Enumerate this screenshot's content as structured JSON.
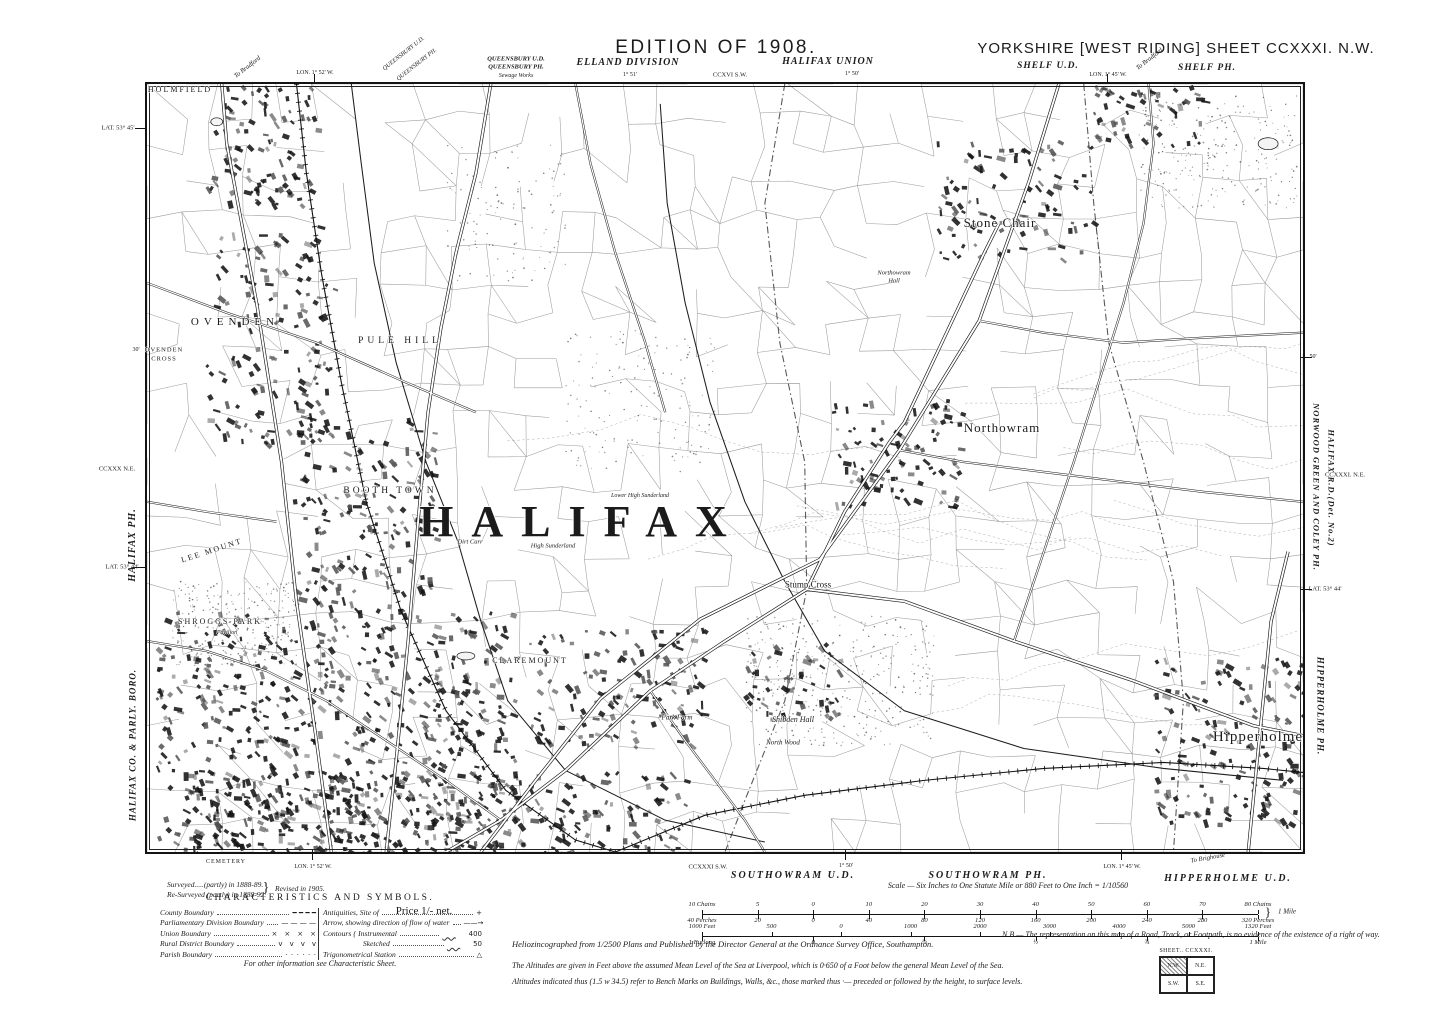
{
  "sheet_meta": {
    "edition": "EDITION OF 1908.",
    "series_title": "YORKSHIRE [WEST RIDING] SHEET CCXXXI. N.W.",
    "main_town": "HALIFAX"
  },
  "annotations": {
    "top": [
      {
        "n": "edition-label",
        "t": "EDITION OF 1908.",
        "x": 716,
        "y": 48,
        "s": 19,
        "f": "sans",
        "ls": 2.5
      },
      {
        "n": "sheet-title",
        "t": "YORKSHIRE [WEST RIDING] SHEET CCXXXI. N.W.",
        "x": 1176,
        "y": 49,
        "s": 15,
        "f": "sans",
        "ls": 1
      },
      {
        "n": "queensbury-ud-label",
        "t": "QUEENSBURY U.D.",
        "x": 516,
        "y": 60,
        "s": 6.5,
        "i": 1,
        "b": 1
      },
      {
        "n": "queensbury-ph-label",
        "t": "QUEENSBURY PH.",
        "x": 516,
        "y": 68,
        "s": 6.5,
        "i": 1,
        "b": 1
      },
      {
        "n": "sewage-works-label",
        "t": "Sewage Works",
        "x": 516,
        "y": 76,
        "s": 6,
        "i": 1
      },
      {
        "n": "elland-division-label",
        "t": "ELLAND DIVISION",
        "x": 628,
        "y": 63,
        "s": 10,
        "i": 1,
        "b": 1,
        "ls": 1
      },
      {
        "n": "lon-1-51-top",
        "t": "1° 51'",
        "x": 630,
        "y": 75,
        "s": 6
      },
      {
        "n": "adjacent-sheet-ccxvi-sw",
        "t": "CCXVI S.W.",
        "x": 730,
        "y": 76,
        "s": 6.5
      },
      {
        "n": "halifax-union-label",
        "t": "HALIFAX UNION",
        "x": 828,
        "y": 62,
        "s": 10,
        "i": 1,
        "b": 1,
        "ls": 1
      },
      {
        "n": "lon-1-50-top",
        "t": "1° 50'",
        "x": 852,
        "y": 74,
        "s": 6
      },
      {
        "n": "shelf-ud-label",
        "t": "SHELF U.D.",
        "x": 1048,
        "y": 67,
        "s": 9.5,
        "i": 1,
        "b": 1,
        "ls": 1
      },
      {
        "n": "lon-1-45-top",
        "t": "LON. 1° 45' W.",
        "x": 1108,
        "y": 75,
        "s": 6
      },
      {
        "n": "shelf-ph-label",
        "t": "SHELF PH.",
        "x": 1207,
        "y": 69,
        "s": 9.5,
        "i": 1,
        "b": 1,
        "ls": 1
      },
      {
        "n": "to-bradford-right",
        "t": "To Bradford",
        "x": 1150,
        "y": 60,
        "s": 6.5,
        "i": 1,
        "rot": -38
      },
      {
        "n": "lon-1-52-top",
        "t": "LON. 1° 52' W.",
        "x": 315,
        "y": 73,
        "s": 6
      },
      {
        "n": "to-bradford-left",
        "t": "To Bradford",
        "x": 248,
        "y": 68,
        "s": 6.5,
        "i": 1,
        "rot": -38
      },
      {
        "n": "queensbury-ud-diagonal",
        "t": "QUEENSBURY U.D.",
        "x": 404,
        "y": 54,
        "s": 6,
        "i": 1,
        "rot": -38
      },
      {
        "n": "queensbury-ph-diagonal",
        "t": "QUEENSBURY PH.",
        "x": 417,
        "y": 65,
        "s": 6,
        "i": 1,
        "rot": -38
      }
    ],
    "left": [
      {
        "n": "lat-53-45-left",
        "t": "LAT. 53° 45'",
        "x": 118,
        "y": 129,
        "s": 6.5
      },
      {
        "n": "min-30-left",
        "t": "30'",
        "x": 136,
        "y": 350,
        "s": 6
      },
      {
        "n": "adjacent-sheet-ccxxx-ne",
        "t": "CCXXX N.E.",
        "x": 117,
        "y": 470,
        "s": 6.5
      },
      {
        "n": "halifax-ph-margin",
        "t": "HALIFAX PH.",
        "x": 133,
        "y": 545,
        "s": 10,
        "i": 1,
        "b": 1,
        "rot": -90,
        "ls": 1
      },
      {
        "n": "lat-53-44-left",
        "t": "LAT. 53° 44'",
        "x": 122,
        "y": 568,
        "s": 6.5
      },
      {
        "n": "halifax-boro-margin",
        "t": "HALIFAX CO. & PARLY. BORO.",
        "x": 133,
        "y": 745,
        "s": 9,
        "i": 1,
        "b": 1,
        "rot": -90,
        "ls": 1
      }
    ],
    "right": [
      {
        "n": "min-50-right",
        "t": "50'",
        "x": 1313,
        "y": 357,
        "s": 6
      },
      {
        "n": "norwood-green-coley-ph-margin",
        "t": "NORWOOD GREEN AND COLEY PH.",
        "x": 1316,
        "y": 487,
        "s": 8.5,
        "i": 1,
        "b": 1,
        "rot": 90,
        "ls": 1
      },
      {
        "n": "halifax-rd-margin",
        "t": "HALIFAX R.D.(Det. No.2)",
        "x": 1331,
        "y": 488,
        "s": 8.5,
        "i": 1,
        "b": 1,
        "rot": 90,
        "ls": 1
      },
      {
        "n": "adjacent-sheet-ccxxxi-ne",
        "t": "CCXXXI. N.E.",
        "x": 1345,
        "y": 476,
        "s": 6.5
      },
      {
        "n": "lat-53-44-right",
        "t": "LAT. 53° 44'",
        "x": 1325,
        "y": 590,
        "s": 6.5
      },
      {
        "n": "hipperholme-ph-margin",
        "t": "HIPPERHOLME PH.",
        "x": 1320,
        "y": 706,
        "s": 9,
        "i": 1,
        "b": 1,
        "rot": 90,
        "ls": 1
      }
    ],
    "bottom": [
      {
        "n": "cemetery-label",
        "t": "CEMETERY",
        "x": 226,
        "y": 862,
        "s": 6,
        "ls": 1
      },
      {
        "n": "lon-1-52-bottom",
        "t": "LON. 1° 52' W.",
        "x": 313,
        "y": 867,
        "s": 6
      },
      {
        "n": "adjacent-sheet-ccxxxi-sw",
        "t": "CCXXXI S.W.",
        "x": 708,
        "y": 868,
        "s": 6.5
      },
      {
        "n": "lon-1-50-bottom",
        "t": "1° 50'",
        "x": 846,
        "y": 866,
        "s": 6
      },
      {
        "n": "southowram-ud-label",
        "t": "SOUTHOWRAM U.D.",
        "x": 793,
        "y": 876,
        "s": 10,
        "i": 1,
        "b": 1,
        "ls": 2
      },
      {
        "n": "southowram-ph-label",
        "t": "SOUTHOWRAM PH.",
        "x": 988,
        "y": 876,
        "s": 10,
        "i": 1,
        "b": 1,
        "ls": 2
      },
      {
        "n": "lon-1-45-bottom",
        "t": "LON. 1° 45' W.",
        "x": 1122,
        "y": 867,
        "s": 6
      },
      {
        "n": "to-brighouse-label",
        "t": "To Brighouse",
        "x": 1208,
        "y": 859,
        "s": 6.5,
        "i": 1,
        "rot": -10
      },
      {
        "n": "hipperholme-ud-label",
        "t": "HIPPERHOLME U.D.",
        "x": 1228,
        "y": 879,
        "s": 10,
        "i": 1,
        "b": 1,
        "ls": 2
      },
      {
        "n": "survey-line-1",
        "t": "Surveyed.....(partly) in 1888-89.",
        "x": 167,
        "y": 881,
        "s": 7.5,
        "i": 1,
        "a": "tl"
      },
      {
        "n": "survey-line-2",
        "t": "Re-Surveyed (partly) in 1888-92.",
        "x": 167,
        "y": 891,
        "s": 7.5,
        "i": 1,
        "a": "tl"
      },
      {
        "n": "survey-brace",
        "t": "}",
        "x": 266,
        "y": 889,
        "s": 14
      },
      {
        "n": "survey-line-3",
        "t": "Revised in 1905.",
        "x": 275,
        "y": 885,
        "s": 7.5,
        "i": 1,
        "a": "tl"
      },
      {
        "n": "characteristics-title",
        "t": "CHARACTERISTICS AND SYMBOLS.",
        "x": 320,
        "y": 899,
        "s": 9.5,
        "ls": 2.5
      },
      {
        "n": "legend-footnote",
        "t": "For other information see Characteristic Sheet.",
        "x": 320,
        "y": 964,
        "s": 8,
        "i": 1
      },
      {
        "n": "price-label",
        "t": "Price 1/- net.",
        "x": 424,
        "y": 912,
        "s": 11
      },
      {
        "n": "scale-caption",
        "t": "Scale — Six Inches to One Statute Mile or 880 Feet to One Inch = 1/10560",
        "x": 1008,
        "y": 886,
        "s": 8,
        "i": 1
      },
      {
        "n": "scale-mile-brace",
        "t": "}",
        "x": 1268,
        "y": 912,
        "s": 13
      },
      {
        "n": "scale-mile-label",
        "t": "1 Mile",
        "x": 1287,
        "y": 912,
        "s": 7,
        "i": 1
      },
      {
        "n": "imprint-line",
        "t": "Heliozincographed from 1/2500 Plans and Published by the Director General at the Ordnance Survey Office, Southampton.",
        "x": 512,
        "y": 940,
        "s": 8.5,
        "i": 1,
        "a": "tl"
      },
      {
        "n": "nb-note",
        "t": "N.B.— The representation on this map of a Road, Track, or Footpath, is no evidence of the existence of a right of way.",
        "x": 1002,
        "y": 931,
        "s": 8,
        "i": 1,
        "a": "tl",
        "w": 440
      },
      {
        "n": "altitude-note-1",
        "t": "The Altitudes are given in Feet above the assumed Mean Level of the Sea at Liverpool, which is 0·650 of a Foot below the general Mean Level of the Sea.",
        "x": 512,
        "y": 962,
        "s": 8,
        "i": 1,
        "a": "tl"
      },
      {
        "n": "altitude-note-2",
        "t": "Altitudes indicated thus (1.5 w 34.5) refer to Bench Marks on Buildings, Walls, &c., those marked thus ·— preceded or followed by the height, to surface levels.",
        "x": 512,
        "y": 978,
        "s": 8,
        "i": 1,
        "a": "tl"
      },
      {
        "n": "sheet-index-title",
        "t": "SHEET.. CCXXXI.",
        "x": 1186,
        "y": 951,
        "s": 5.8,
        "ls": 0.5
      }
    ]
  },
  "map_labels": [
    {
      "n": "label-holmfield",
      "t": "HOLMFIELD",
      "x": 180,
      "y": 90,
      "s": 8,
      "ls": 2
    },
    {
      "n": "label-ovenden",
      "t": "OVENDEN",
      "x": 235,
      "y": 323,
      "s": 11,
      "ls": 5
    },
    {
      "n": "label-ovenden-cross-1",
      "t": "OVENDEN",
      "x": 164,
      "y": 351,
      "s": 6.5,
      "ls": 1
    },
    {
      "n": "label-ovenden-cross-2",
      "t": "CROSS",
      "x": 164,
      "y": 360,
      "s": 6.5,
      "ls": 1
    },
    {
      "n": "label-pule-hill",
      "t": "PULE HILL",
      "x": 400,
      "y": 342,
      "s": 9.5,
      "ls": 4
    },
    {
      "n": "label-booth-town",
      "t": "BOOTH TOWN",
      "x": 390,
      "y": 492,
      "s": 9.5,
      "ls": 3
    },
    {
      "n": "label-halifax",
      "t": "HALIFAX",
      "x": 582,
      "y": 522,
      "s": 44,
      "ls": 18,
      "b": 1
    },
    {
      "n": "label-lee-mount",
      "t": "LEE MOUNT",
      "x": 212,
      "y": 551,
      "s": 8,
      "ls": 2,
      "rot": -18
    },
    {
      "n": "label-shroggs-park",
      "t": "SHROGGS PARK",
      "x": 220,
      "y": 622,
      "s": 8,
      "ls": 2
    },
    {
      "n": "label-pavilion",
      "t": "Pavilion",
      "x": 227,
      "y": 633,
      "s": 6,
      "i": 1
    },
    {
      "n": "label-stone-chair",
      "t": "Stone Chair",
      "x": 1000,
      "y": 223,
      "s": 13,
      "ls": 1
    },
    {
      "n": "label-northowram",
      "t": "Northowram",
      "x": 1002,
      "y": 428,
      "s": 13,
      "ls": 1
    },
    {
      "n": "label-northowram-hall-1",
      "t": "Northowram",
      "x": 894,
      "y": 274,
      "s": 6.5,
      "i": 1
    },
    {
      "n": "label-northowram-hall-2",
      "t": "Hall",
      "x": 894,
      "y": 282,
      "s": 6.5,
      "i": 1
    },
    {
      "n": "label-stump-cross",
      "t": "Stump Cross",
      "x": 808,
      "y": 585,
      "s": 9
    },
    {
      "n": "label-claremount",
      "t": "CLAREMOUNT",
      "x": 530,
      "y": 661,
      "s": 8,
      "ls": 2
    },
    {
      "n": "label-shibden-hall",
      "t": "Shibden Hall",
      "x": 793,
      "y": 720,
      "s": 8,
      "i": 1
    },
    {
      "n": "label-park-farm",
      "t": "Park Farm",
      "x": 677,
      "y": 718,
      "s": 7,
      "i": 1
    },
    {
      "n": "label-north-wood",
      "t": "North Wood",
      "x": 783,
      "y": 743,
      "s": 7,
      "i": 1
    },
    {
      "n": "label-high-sunderland",
      "t": "High Sunderland",
      "x": 553,
      "y": 547,
      "s": 6.5,
      "i": 1
    },
    {
      "n": "label-lower-high-sunderland",
      "t": "Lower High Sunderland",
      "x": 640,
      "y": 496,
      "s": 6,
      "i": 1
    },
    {
      "n": "label-dirt-carr",
      "t": "Dirt Carr",
      "x": 470,
      "y": 543,
      "s": 6.5,
      "i": 1
    },
    {
      "n": "label-hipperholme",
      "t": "Hipperholme",
      "x": 1258,
      "y": 738,
      "s": 15,
      "ls": 1
    }
  ],
  "legend": {
    "left": [
      {
        "label": "County Boundary",
        "sym": "━ ━ ━ ━"
      },
      {
        "label": "Parliamentary Division Boundary",
        "sym": "— — — —"
      },
      {
        "label": "Union Boundary",
        "sym": "× × × ×"
      },
      {
        "label": "Rural District Boundary",
        "sym": "v v v v"
      },
      {
        "label": "Parish Boundary",
        "sym": "· · · · · ·"
      }
    ],
    "right": [
      {
        "label": "Antiquities, Site of",
        "sym": "+"
      },
      {
        "label": "Arrow, showing direction of flow of water",
        "sym": "——→"
      },
      {
        "label": "Contours { Instrumental",
        "sym": "400",
        "wavy": true
      },
      {
        "label": "      Sketched",
        "sym": "50",
        "wavy": true
      },
      {
        "label": "Trigonometrical Station",
        "sym": "△"
      }
    ]
  },
  "scale_bars": {
    "chains_top": [
      "10 Chains",
      "5",
      "0",
      "10",
      "20",
      "30",
      "40",
      "50",
      "60",
      "70",
      "80 Chains"
    ],
    "perches_bottom": [
      "40 Perches",
      "20",
      "0",
      "40",
      "80",
      "120",
      "160",
      "200",
      "240",
      "280",
      "320 Perches"
    ],
    "feet_top": [
      "1000 Feet",
      "500",
      "0",
      "1000",
      "2000",
      "3000",
      "4000",
      "5000",
      "1320 Feet"
    ],
    "furlong_bottom": [
      "1 Furlong",
      "0",
      "¼",
      "½",
      "¾",
      "1 Mile"
    ]
  },
  "sheet_index": {
    "title": "SHEET.. CCXXXI.",
    "cells": [
      "N.W.",
      "N.E.",
      "S.W.",
      "S.E."
    ]
  },
  "colors": {
    "ink": "#1b1b1b",
    "paper": "#ffffff"
  }
}
